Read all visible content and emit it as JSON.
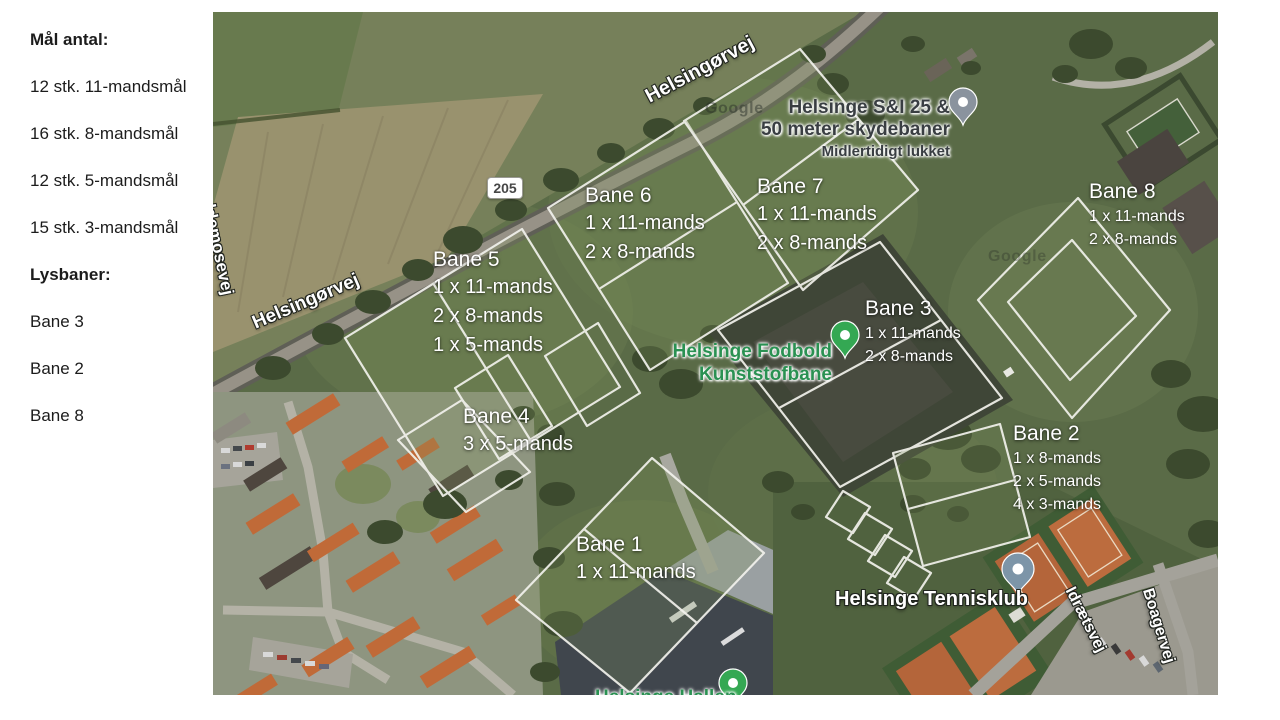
{
  "sidebar": {
    "goals_header": "Mål antal:",
    "goals": [
      "12 stk. 11-mandsmål",
      "16 stk. 8-mandsmål",
      "12 stk. 5-mandsmål",
      "15 stk. 3-mandsmål"
    ],
    "light_header": "Lysbaner:",
    "light_fields": [
      "Bane 3",
      "Bane 2",
      "Bane 8"
    ]
  },
  "map": {
    "roads": {
      "helsingorvej_top": "Helsingørvej",
      "helsingorvej_left": "Helsingørvej",
      "eldemosevej": "eldemosevej",
      "route_number": "205",
      "idraetsvej": "Idrætsvej",
      "boagervej": "Boagervej"
    },
    "pois": {
      "skydebaner_line1": "Helsinge S&I 25 &",
      "skydebaner_line2": "50 meter skydebaner",
      "skydebaner_status": "Midlertidigt lukket",
      "fodbold_line1": "Helsinge Fodbold",
      "fodbold_line2": "Kunststofbane",
      "tennisklub": "Helsinge Tennisklub",
      "hallen": "Helsinge Hallen"
    },
    "watermark": "Google",
    "fields": [
      {
        "id": "bane5",
        "title": "Bane 5",
        "lines": [
          "1 x 11-mands",
          "2 x 8-mands",
          "1 x 5-mands"
        ]
      },
      {
        "id": "bane6",
        "title": "Bane 6",
        "lines": [
          "1 x 11-mands",
          "2 x 8-mands"
        ]
      },
      {
        "id": "bane7",
        "title": "Bane 7",
        "lines": [
          "1 x 11-mands",
          "2 x 8-mands"
        ]
      },
      {
        "id": "bane8",
        "title": "Bane 8",
        "lines": [
          "1 x 11-mands",
          "2 x 8-mands"
        ]
      },
      {
        "id": "bane3",
        "title": "Bane 3",
        "lines": [
          "1 x 11-mands",
          "2 x 8-mands"
        ]
      },
      {
        "id": "bane4",
        "title": "Bane 4",
        "lines": [
          "3 x 5-mands"
        ]
      },
      {
        "id": "bane2",
        "title": "Bane 2",
        "lines": [
          "1 x 8-mands",
          "2 x 5-mands",
          "4 x 3-mands"
        ]
      },
      {
        "id": "bane1",
        "title": "Bane 1",
        "lines": [
          "1 x 11-mands"
        ]
      }
    ],
    "colors": {
      "pin_green": "#34a853",
      "pin_gray": "#8a939e",
      "pin_blue": "#7d95a8",
      "poi_green": "#2a9152",
      "field_outline": "#f2f2ec"
    }
  }
}
